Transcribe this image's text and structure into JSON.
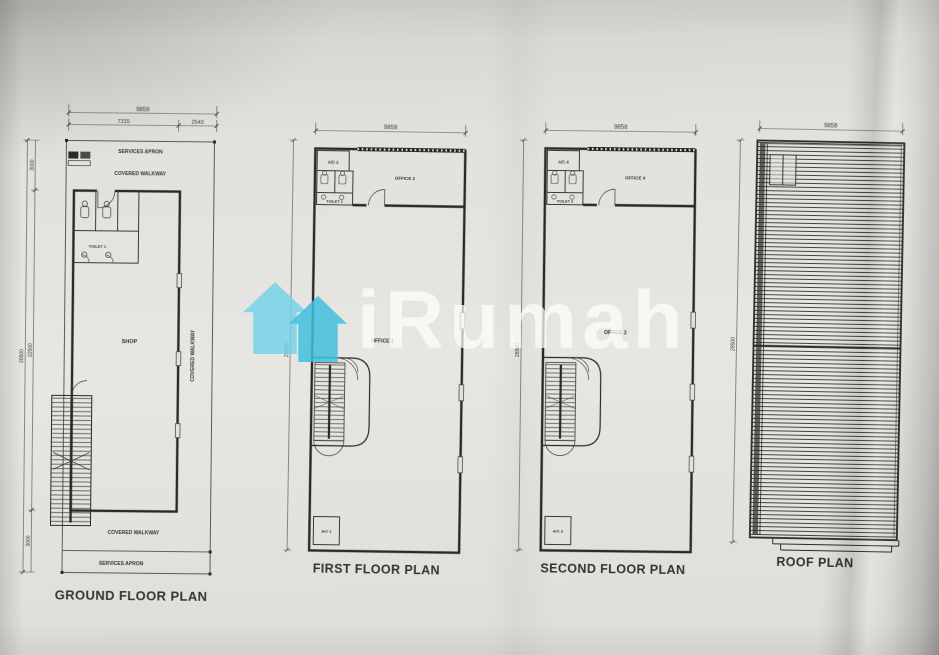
{
  "photo": {
    "paper_color": "#e2e1de",
    "ink_color": "#34332f"
  },
  "watermark": {
    "brand_text": "iRumah",
    "logo_color_left": "#72d2e8",
    "logo_color_right": "#3fc0dd",
    "text_color": "rgba(253,253,251,0.72)"
  },
  "ground_floor": {
    "title": "GROUND FLOOR PLAN",
    "dims": {
      "width_total": "9858",
      "width_left": "7315",
      "width_right": "2543",
      "height_total": "28500",
      "height_inner": "22500",
      "height_top": "3000",
      "height_bottom": "3000"
    },
    "labels": {
      "services_apron_top": "SERVICES APRON",
      "covered_walkway_top": "COVERED WALKWAY",
      "toilet": "TOILET 1",
      "shop": "SHOP",
      "covered_walkway_right": "COVERED WALKWAY",
      "covered_walkway_bottom": "COVERED WALKWAY",
      "services_apron_bottom": "SERVICES APRON"
    }
  },
  "first_floor": {
    "title": "FIRST FLOOR PLAN",
    "dims": {
      "width_total": "9858",
      "height_total": "28500"
    },
    "labels": {
      "ac_top": "A/C 2",
      "toilet": "TOILET 2",
      "office_top": "OFFICE 2",
      "office_main": "OFFICE 1",
      "ac_bottom": "A/C 1"
    }
  },
  "second_floor": {
    "title": "SECOND FLOOR PLAN",
    "dims": {
      "width_total": "9858",
      "height_total": "28500"
    },
    "labels": {
      "ac_top": "A/C 4",
      "toilet": "TOILET 3",
      "office_top": "OFFICE 4",
      "office_main": "OFFICE 3",
      "ac_bottom": "A/C 3"
    }
  },
  "roof": {
    "title": "ROOF PLAN",
    "dims": {
      "width_total": "9858",
      "height_total": "28500"
    }
  }
}
